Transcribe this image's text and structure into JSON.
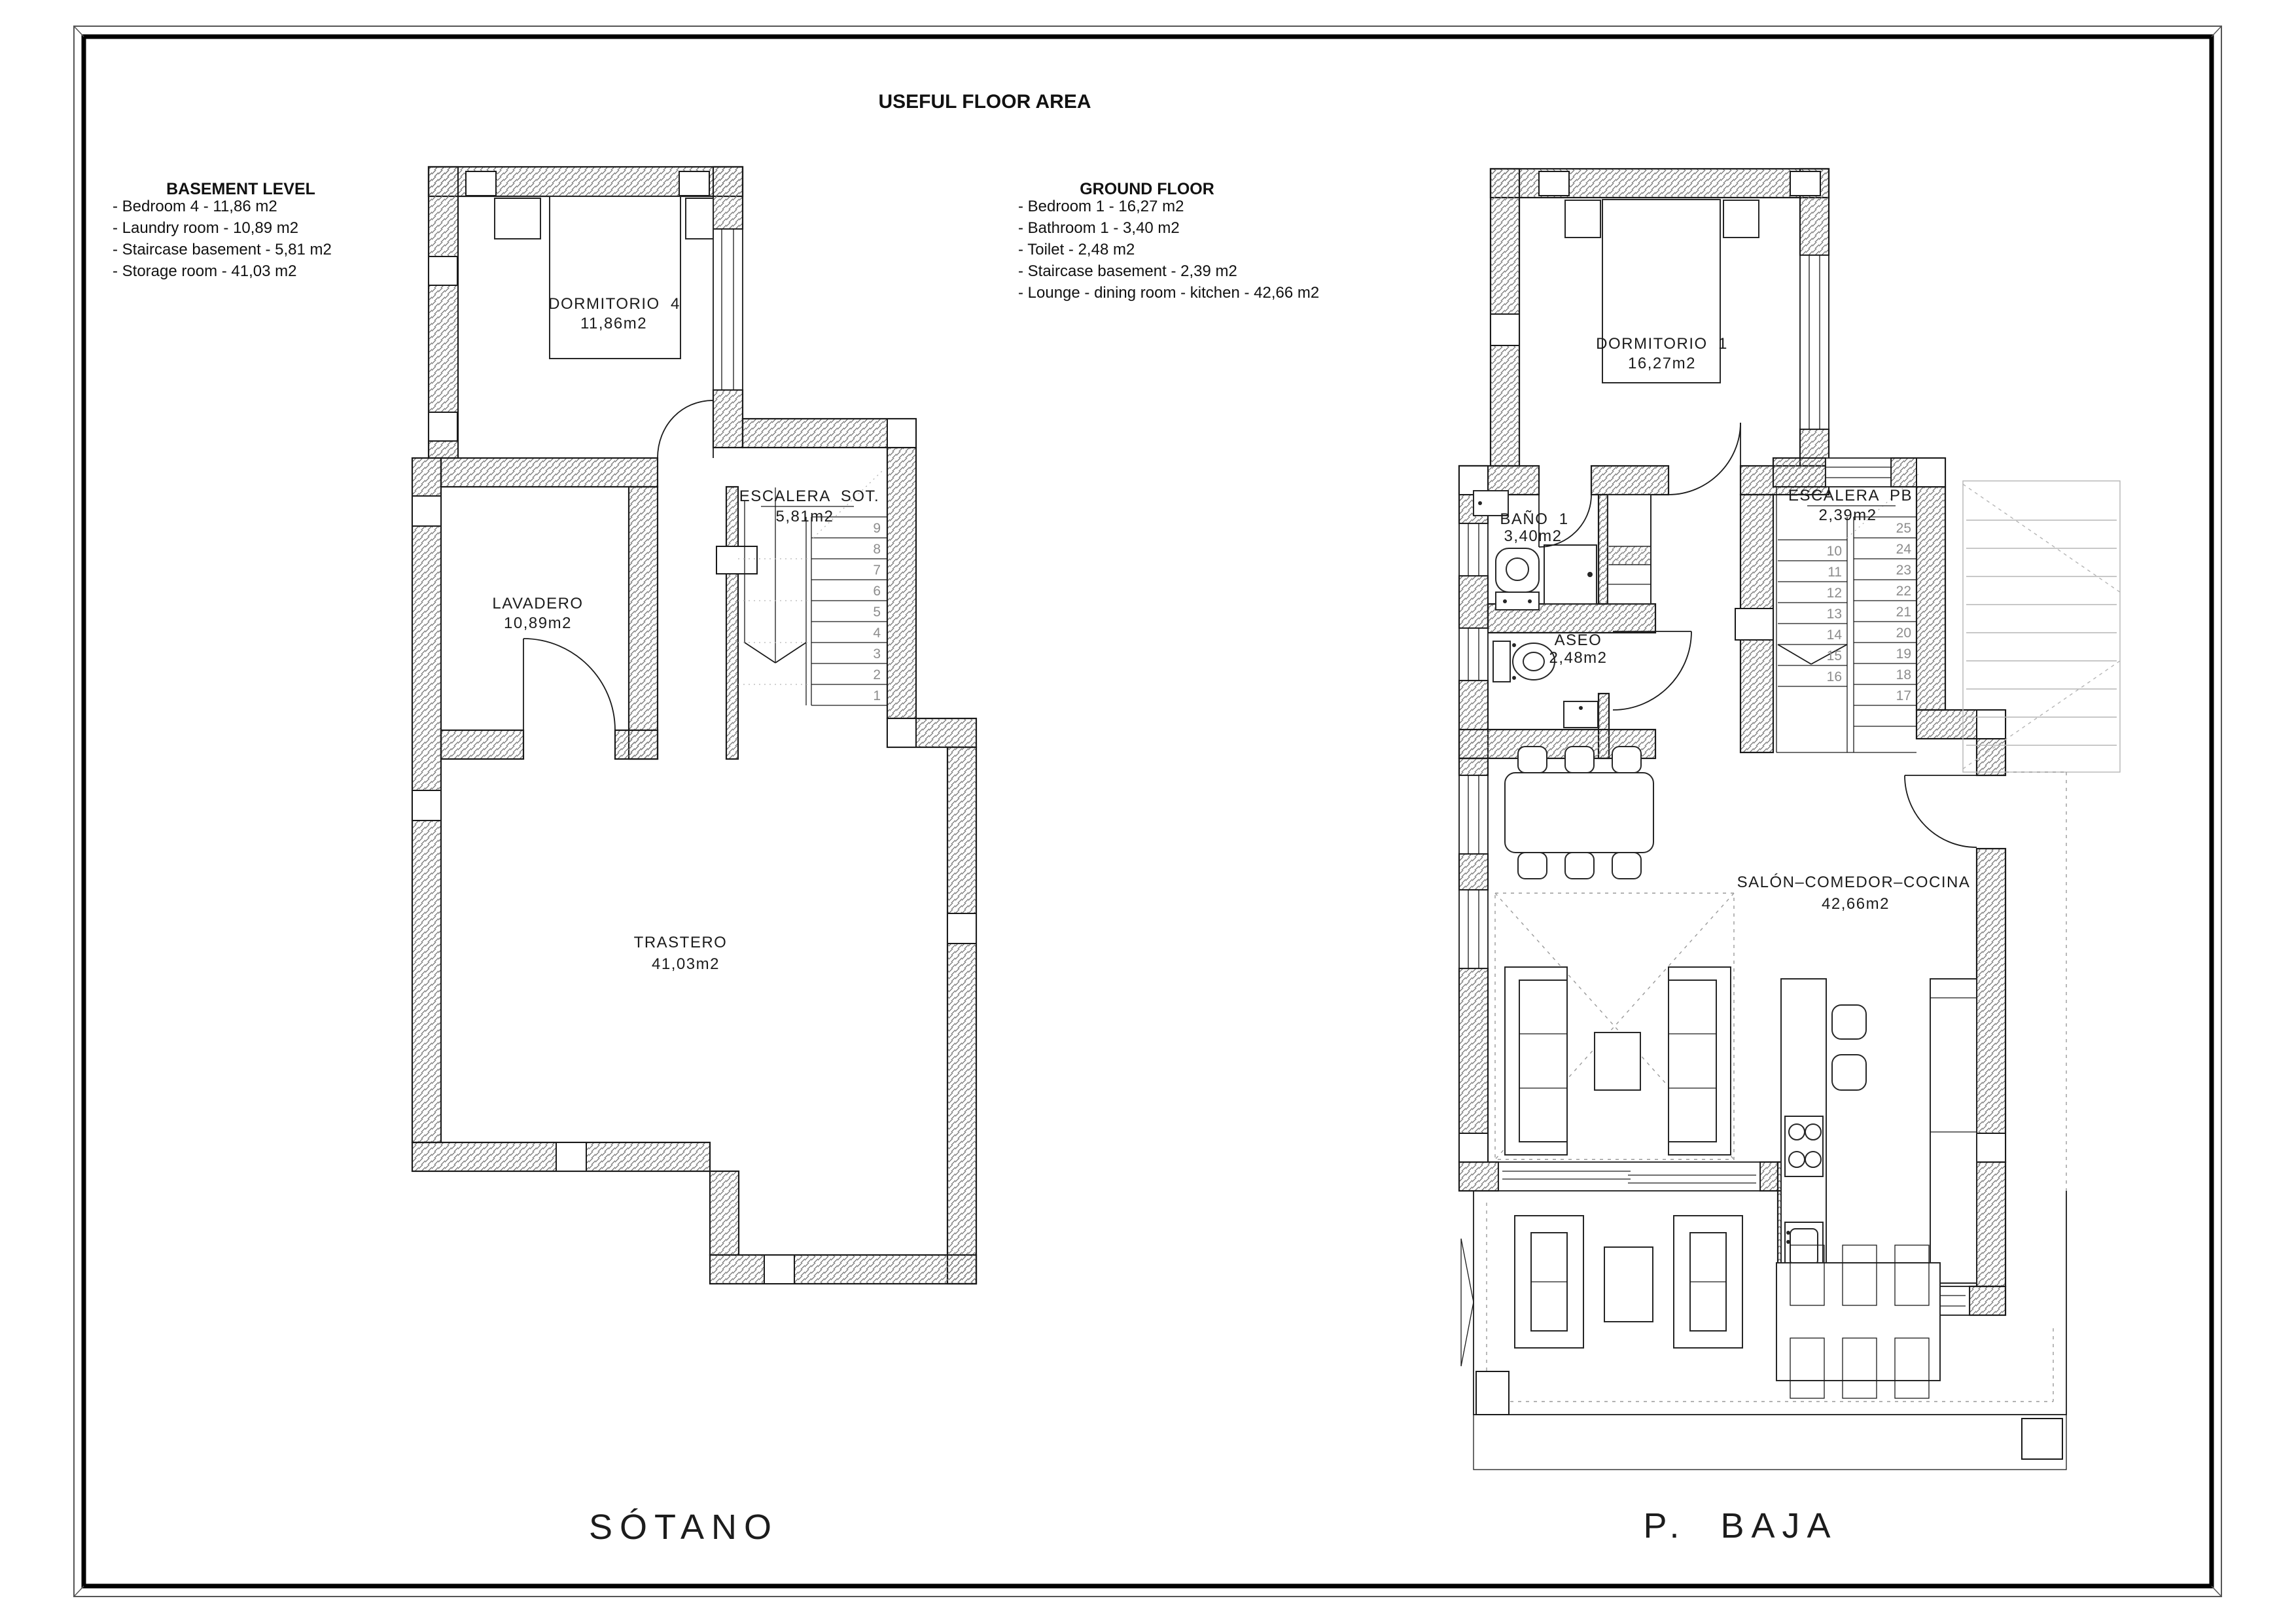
{
  "title": "USEFUL FLOOR AREA",
  "colors": {
    "line": "#1a1a1a",
    "hatch": "#6e6e6e",
    "stair_number": "#8c8c8c",
    "dashed": "#9a9a9a",
    "background": "#ffffff"
  },
  "legends": {
    "basement": {
      "title": "BASEMENT LEVEL",
      "items": [
        "- Bedroom 4 - 11,86 m2",
        "- Laundry room - 10,89 m2",
        "- Staircase basement - 5,81 m2",
        "- Storage room - 41,03 m2"
      ]
    },
    "ground": {
      "title": "GROUND FLOOR",
      "items": [
        "- Bedroom 1 - 16,27 m2",
        "- Bathroom 1 - 3,40 m2",
        "- Toilet - 2,48 m2",
        "- Staircase basement - 2,39 m2",
        "- Lounge - dining room - kitchen - 42,66 m2"
      ]
    }
  },
  "basement": {
    "floor_label": "SÓTANO",
    "dormitorio4_name": "DORMITORIO  4",
    "dormitorio4_area": "11,86m2",
    "lavadero_name": "LAVADERO",
    "lavadero_area": "10,89m2",
    "escalera_name": "ESCALERA  SOT.",
    "escalera_area": "5,81m2",
    "trastero_name": "TRASTERO",
    "trastero_area": "41,03m2",
    "stairs": [
      "1",
      "2",
      "3",
      "4",
      "5",
      "6",
      "7",
      "8",
      "9"
    ]
  },
  "ground": {
    "floor_label": "P.  BAJA",
    "dormitorio1_name": "DORMITORIO  1",
    "dormitorio1_area": "16,27m2",
    "bano_name": "BAÑO  1",
    "bano_area": "3,40m2",
    "aseo_name": "ASEO",
    "aseo_area": "2,48m2",
    "escalera_name": "ESCALERA  PB",
    "escalera_area": "2,39m2",
    "salon_name": "SALÓN–COMEDOR–COCINA",
    "salon_area": "42,66m2",
    "stairs_left": [
      "10",
      "11",
      "12",
      "13",
      "14",
      "15",
      "16"
    ],
    "stairs_right": [
      "17",
      "18",
      "19",
      "20",
      "21",
      "22",
      "23",
      "24",
      "25"
    ]
  }
}
